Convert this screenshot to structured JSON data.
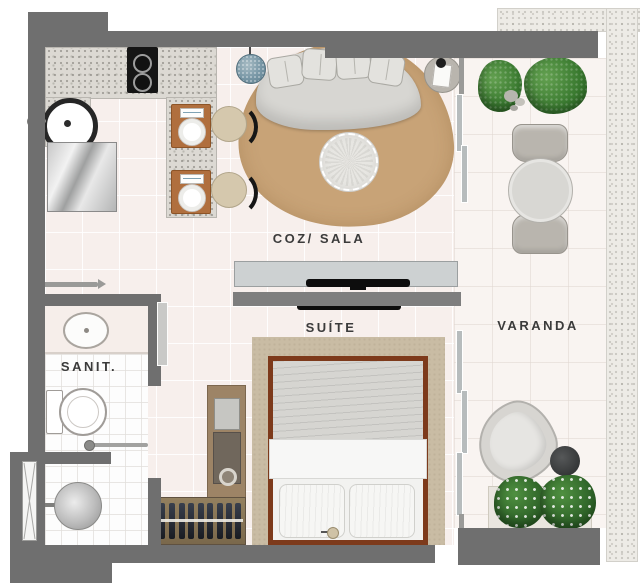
{
  "plan_title": "studio-apartment-floor-plan",
  "rooms": [
    {
      "name": "kitchen-living",
      "label": "COZ/ SALA"
    },
    {
      "name": "suite",
      "label": "SUÍTE"
    },
    {
      "name": "bathroom",
      "label": "SANIT."
    },
    {
      "name": "balcony",
      "label": "VARANDA"
    }
  ],
  "colors": {
    "wall": "#6f6f6f",
    "partition": "#7e7e7e",
    "floor_main": "#f7efec",
    "floor_balcony": "#f9f4f1",
    "floor_bathroom": "#fdfdfd",
    "counter_granite": "#dcd9d3",
    "facade_band": "#edebe6",
    "living_rug": "#c8a377",
    "bedroom_rug": "#c9bca4",
    "bed_frame": "#7d3a1b",
    "sofa": "#d7d6d2",
    "plant_green": "#3a7a30",
    "pendant_blue": "#7796a5",
    "wood_board": "#b06f3e",
    "wardrobe_wood": "#9d8466",
    "tv_black": "#0d0d0d"
  },
  "furniture_icons": [
    "sofa",
    "pillow",
    "pouf",
    "living-rug",
    "side-table",
    "table-lamp",
    "pendant-lamp",
    "cooktop",
    "kitchen-sink",
    "refrigerator",
    "bar-counter",
    "place-setting",
    "stool",
    "tv-console",
    "tv",
    "bed",
    "wardrobe",
    "clothes-rack",
    "toilet",
    "washbasin",
    "towel-bar",
    "shower",
    "shower-glass",
    "dining-table",
    "dining-chair",
    "lounge-chair",
    "coffee-table",
    "plant",
    "planter",
    "sliding-glass-door",
    "entry-door"
  ]
}
